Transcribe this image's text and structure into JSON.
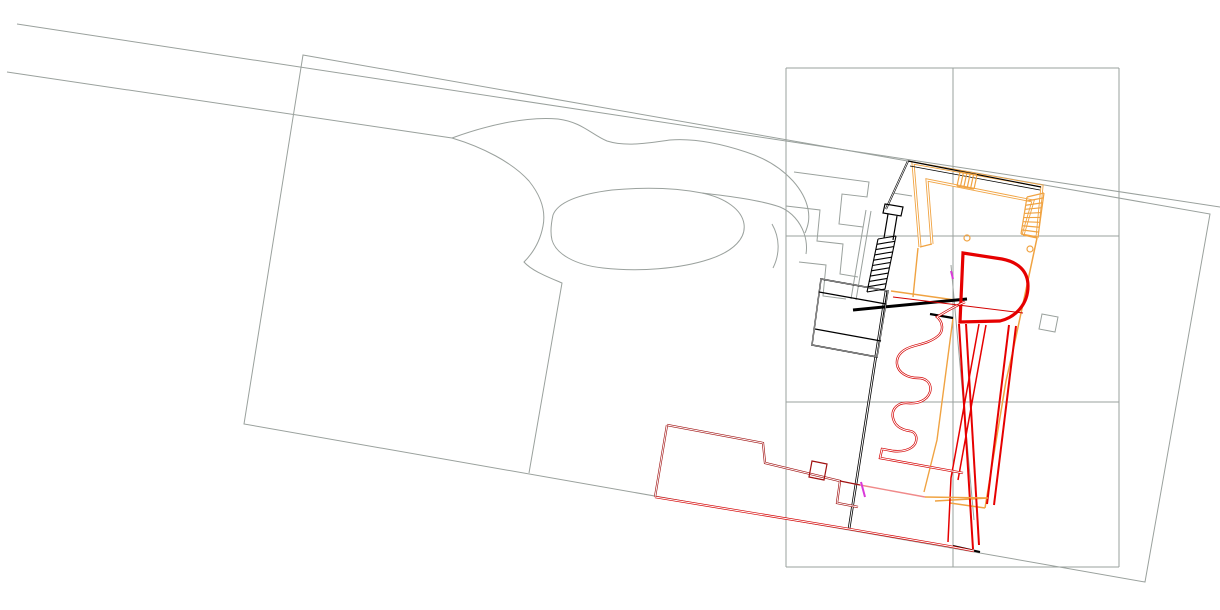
{
  "canvas": {
    "width": 1220,
    "height": 610,
    "background": "#ffffff"
  },
  "palette": {
    "survey_gray": "#9aa19d",
    "building_black": "#000000",
    "roof_orange": "#f0a342",
    "wall_red": "#e60000",
    "thin_red": "#d40000",
    "dark_red": "#a01010",
    "accent_pink": "#f08a8a",
    "accent_magenta": "#d939d9",
    "paper_white": "#ffffff"
  },
  "drawing": {
    "layers": [
      {
        "name": "survey-linework",
        "color": "#9aa19d",
        "width": 1,
        "paths": [
          {
            "name": "road-edge-north",
            "d": "M 17,24 L 1220,207"
          },
          {
            "name": "road-edge-south",
            "d": "M 7,72 L 452,138 C 482,147 512,162 529,181 C 541,196 546,211 543,226 C 540,242 532,254 524,262 C 532,271 548,277 562,283 L 529,473"
          },
          {
            "name": "driveway-north-edge",
            "d": "M 452,138 C 485,126 525,116 558,119 C 582,122 592,135 607,141 C 626,147 648,143 670,140 C 696,138 722,144 746,152 C 768,159 782,169 793,181 C 801,190 806,199 808,209 C 810,219 808,226 805,233"
          },
          {
            "name": "driveway-south-edge",
            "d": "M 702,193 C 728,196 760,200 780,207 C 792,212 800,222 804,233 C 807,242 807,248 806,254"
          },
          {
            "name": "pond-outline",
            "d": "M 553,215 C 558,202 580,194 612,190 C 645,187 676,188 702,193 C 726,198 742,210 744,224 C 746,238 734,251 710,259 C 680,269 638,272 603,268 C 575,265 556,254 552,240 C 550,232 551,224 553,215 Z"
          },
          {
            "name": "property-boundary",
            "d": "M 303,55 L 1210,214 L 1145,582 L 244,424 Z"
          },
          {
            "name": "grid-vertical-left",
            "d": "M 786,68 L 786,567"
          },
          {
            "name": "grid-vertical-center",
            "d": "M 953,68 L 953,567"
          },
          {
            "name": "grid-vertical-right",
            "d": "M 1119,68 L 1119,567"
          },
          {
            "name": "grid-horizontal-top",
            "d": "M 786,68 L 1119,68"
          },
          {
            "name": "grid-horizontal-2",
            "d": "M 786,236 L 1119,236"
          },
          {
            "name": "grid-horizontal-3",
            "d": "M 786,402 L 1119,402"
          },
          {
            "name": "grid-horizontal-bottom",
            "d": "M 786,567 L 1119,567"
          },
          {
            "name": "drive-tilt-line",
            "d": "M 951,265 L 974,520"
          },
          {
            "name": "small-pad-square",
            "d": "M 1042,314 L 1058,317 L 1055,332 L 1039,329 Z"
          },
          {
            "name": "terrace-step-1",
            "d": "M 794,172 L 869,182 L 867,197 L 842,194 L 839,224 L 863,227"
          },
          {
            "name": "terrace-step-2",
            "d": "M 786,206 L 820,210 L 817,241 L 843,244 L 840,274 L 858,277"
          },
          {
            "name": "terrace-step-3",
            "d": "M 799,262 L 826,265 L 823,296 L 846,299"
          },
          {
            "name": "terrace-rail-a",
            "d": "M 866,210 L 851,299"
          },
          {
            "name": "terrace-rail-b",
            "d": "M 871,211 L 856,300"
          },
          {
            "name": "terrace-arc",
            "d": "M 772,224 C 780,238 780,254 773,268"
          },
          {
            "name": "terrace-stub",
            "d": "M 893,193 L 912,196"
          }
        ]
      },
      {
        "name": "orange-roof",
        "color": "#f0a342",
        "width": 1.4,
        "paths": [
          {
            "name": "roof-outer-edge",
            "d": "M 920,247 L 913,163 L 1042,186 L 1037,238",
            "width": 3,
            "overlay": 1.2
          },
          {
            "name": "roof-inner-edge",
            "d": "M 932,244 L 927,180 L 1033,201 L 1023,235",
            "width": 3,
            "overlay": 1.2
          },
          {
            "name": "roof-leg-close-left",
            "d": "M 920,247 L 932,244"
          },
          {
            "name": "roof-leg-close-right",
            "d": "M 1037,238 L 1023,235"
          },
          {
            "name": "roof-east-edge-outer",
            "d": "M 1037,238 L 1014,346 L 1006,381 L 985,508",
            "width": 1.5
          },
          {
            "name": "roof-east-edge-inner",
            "d": "M 953,318 L 937,440 L 924,492"
          },
          {
            "name": "roof-corner-south-a",
            "d": "M 985,508 L 950,503"
          },
          {
            "name": "roof-corner-south-b",
            "d": "M 935,501 L 988,498"
          },
          {
            "name": "roof-line-over-wall",
            "d": "M 891,291 L 955,300",
            "width": 1.5
          },
          {
            "name": "roof-left-leg-extension",
            "d": "M 918,248 L 913,297"
          }
        ]
      },
      {
        "name": "black-building",
        "color": "#000000",
        "width": 1.2,
        "paths": [
          {
            "name": "black-roofline-top",
            "d": "M 908,161 L 1041,187"
          },
          {
            "name": "black-under-orange",
            "d": "M 910,166 L 1040,190",
            "width": 0.8
          },
          {
            "name": "black-west-edge",
            "d": "M 908,161 L 886,209",
            "width": 2,
            "overlay": 0.8
          },
          {
            "name": "entry-column-box",
            "d": "M 885,204 L 903,207 L 901,216 L 883,213 Z"
          },
          {
            "name": "upper-flight-a",
            "d": "M 888,214 L 884,238"
          },
          {
            "name": "upper-flight-b",
            "d": "M 897,216 L 893,240"
          },
          {
            "name": "main-wall-long",
            "d": "M 886,291 L 849,529",
            "width": 2.6,
            "overlay": 1
          },
          {
            "name": "thick-wall-main",
            "d": "M 853,310 L 967,299",
            "width": 3
          },
          {
            "name": "thick-wall-short",
            "d": "M 930,314 L 953,318",
            "width": 2.4
          },
          {
            "name": "west-wing-outline",
            "d": "M 821,279 L 888,291 L 877,357 L 812,345 Z",
            "width": 1.4,
            "overlay": 0.5
          },
          {
            "name": "west-wing-divider-1",
            "d": "M 819,292 L 886,304"
          },
          {
            "name": "west-wing-divider-2",
            "d": "M 815,329 L 881,341"
          },
          {
            "name": "bottom-sill",
            "d": "M 953,546 L 980,552",
            "width": 2
          }
        ]
      },
      {
        "name": "red-building",
        "color": "#e60000",
        "width": 1.2,
        "paths": [
          {
            "name": "d-shape-pavilion",
            "d": "M 963,253 L 1002,259 C 1018,262 1028,271 1028,286 C 1028,304 1016,317 1000,321 L 960,322 L 963,253 Z",
            "width": 3.2
          },
          {
            "name": "east-wall-pair-a1",
            "d": "M 959,324 L 973,549",
            "width": 2
          },
          {
            "name": "east-wall-pair-a2",
            "d": "M 966,324 L 979,545",
            "width": 2
          },
          {
            "name": "east-wall-pair-b1",
            "d": "M 1016,326 L 994,505",
            "width": 2
          },
          {
            "name": "east-wall-pair-b2",
            "d": "M 1009,325 L 987,504",
            "width": 2
          },
          {
            "name": "inner-wall-c1",
            "d": "M 979,324 L 951,478 L 948,542",
            "width": 1.5
          },
          {
            "name": "inner-wall-c2",
            "d": "M 986,325 L 958,480",
            "width": 1.5
          },
          {
            "name": "serpentine-wall",
            "d": "M 965,302 C 955,306 945,312 937,317 C 943,322 944,331 938,336 C 931,342 921,344 914,346 C 903,349 896,355 897,364 C 898,373 908,378 918,378 C 927,378 932,384 930,392 C 927,401 917,404 908,403 C 898,402 891,409 893,418 C 895,427 903,430 910,431 C 916,432 918,438 915,444 C 911,450 902,452 893,451 L 882,449 L 880,458 L 963,473",
            "width": 2.4,
            "overlay": 1,
            "color": "#d40000"
          },
          {
            "name": "thin-red-long",
            "d": "M 893,297 L 1023,313",
            "width": 1,
            "color": "#d40000"
          },
          {
            "name": "south-bottom-edge",
            "d": "M 655,497 L 849,529 L 948,546 L 974,551",
            "width": 2.4,
            "overlay": 1,
            "color": "#d40000"
          },
          {
            "name": "lower-building-top",
            "d": "M 667,425 L 763,443 L 765,463 L 840,481 L 837,503 L 858,507",
            "width": 2.2,
            "overlay": 0.9,
            "color": "#a01010"
          },
          {
            "name": "lower-building-west",
            "d": "M 667,425 L 655,497",
            "width": 2.2,
            "overlay": 0.9,
            "color": "#a01010"
          },
          {
            "name": "lower-building-notch",
            "d": "M 812,461 L 827,464 L 824,480 L 809,477 Z",
            "width": 1.2,
            "color": "#a01010"
          },
          {
            "name": "lower-building-link",
            "d": "M 840,481 L 860,485",
            "width": 1.4,
            "color": "#a01010"
          }
        ]
      },
      {
        "name": "accents",
        "color": "#f08a8a",
        "width": 1.4,
        "paths": [
          {
            "name": "pink-edge",
            "d": "M 860,485 L 925,497",
            "color": "#f08a8a"
          },
          {
            "name": "orange-edge-continue",
            "d": "M 925,497 L 988,498",
            "color": "#f0a342"
          },
          {
            "name": "magenta-door-1",
            "d": "M 861,482 L 865,497",
            "width": 2,
            "color": "#d939d9"
          },
          {
            "name": "magenta-door-2",
            "d": "M 951,271 L 953,279",
            "width": 2,
            "color": "#d939d9"
          }
        ]
      }
    ],
    "ladders": [
      {
        "name": "black-staircase",
        "color": "#000000",
        "width": 1.1,
        "railA": [
          [
            878,
            239
          ],
          [
            867,
            292
          ]
        ],
        "railB": [
          [
            896,
            236
          ],
          [
            885,
            289
          ]
        ],
        "rungs": 10,
        "drawRails": true
      },
      {
        "name": "orange-top-stair",
        "color": "#f0a342",
        "width": 1.2,
        "railA": [
          [
            960,
            172
          ],
          [
            977,
            175
          ]
        ],
        "railB": [
          [
            957,
            186
          ],
          [
            974,
            189
          ]
        ],
        "rungs": 5,
        "drawRails": true
      },
      {
        "name": "orange-right-stair",
        "color": "#f0a342",
        "width": 1.2,
        "railA": [
          [
            1027,
            197
          ],
          [
            1021,
            234
          ]
        ],
        "railB": [
          [
            1044,
            193
          ],
          [
            1038,
            237
          ]
        ],
        "rungs": 9,
        "drawRails": true
      }
    ],
    "circles": [
      {
        "name": "orange-marker-circle-1",
        "cx": 967,
        "cy": 238,
        "r": 3,
        "color": "#f0a342"
      },
      {
        "name": "orange-marker-circle-2",
        "cx": 1030,
        "cy": 249,
        "r": 3,
        "color": "#f0a342"
      }
    ]
  }
}
